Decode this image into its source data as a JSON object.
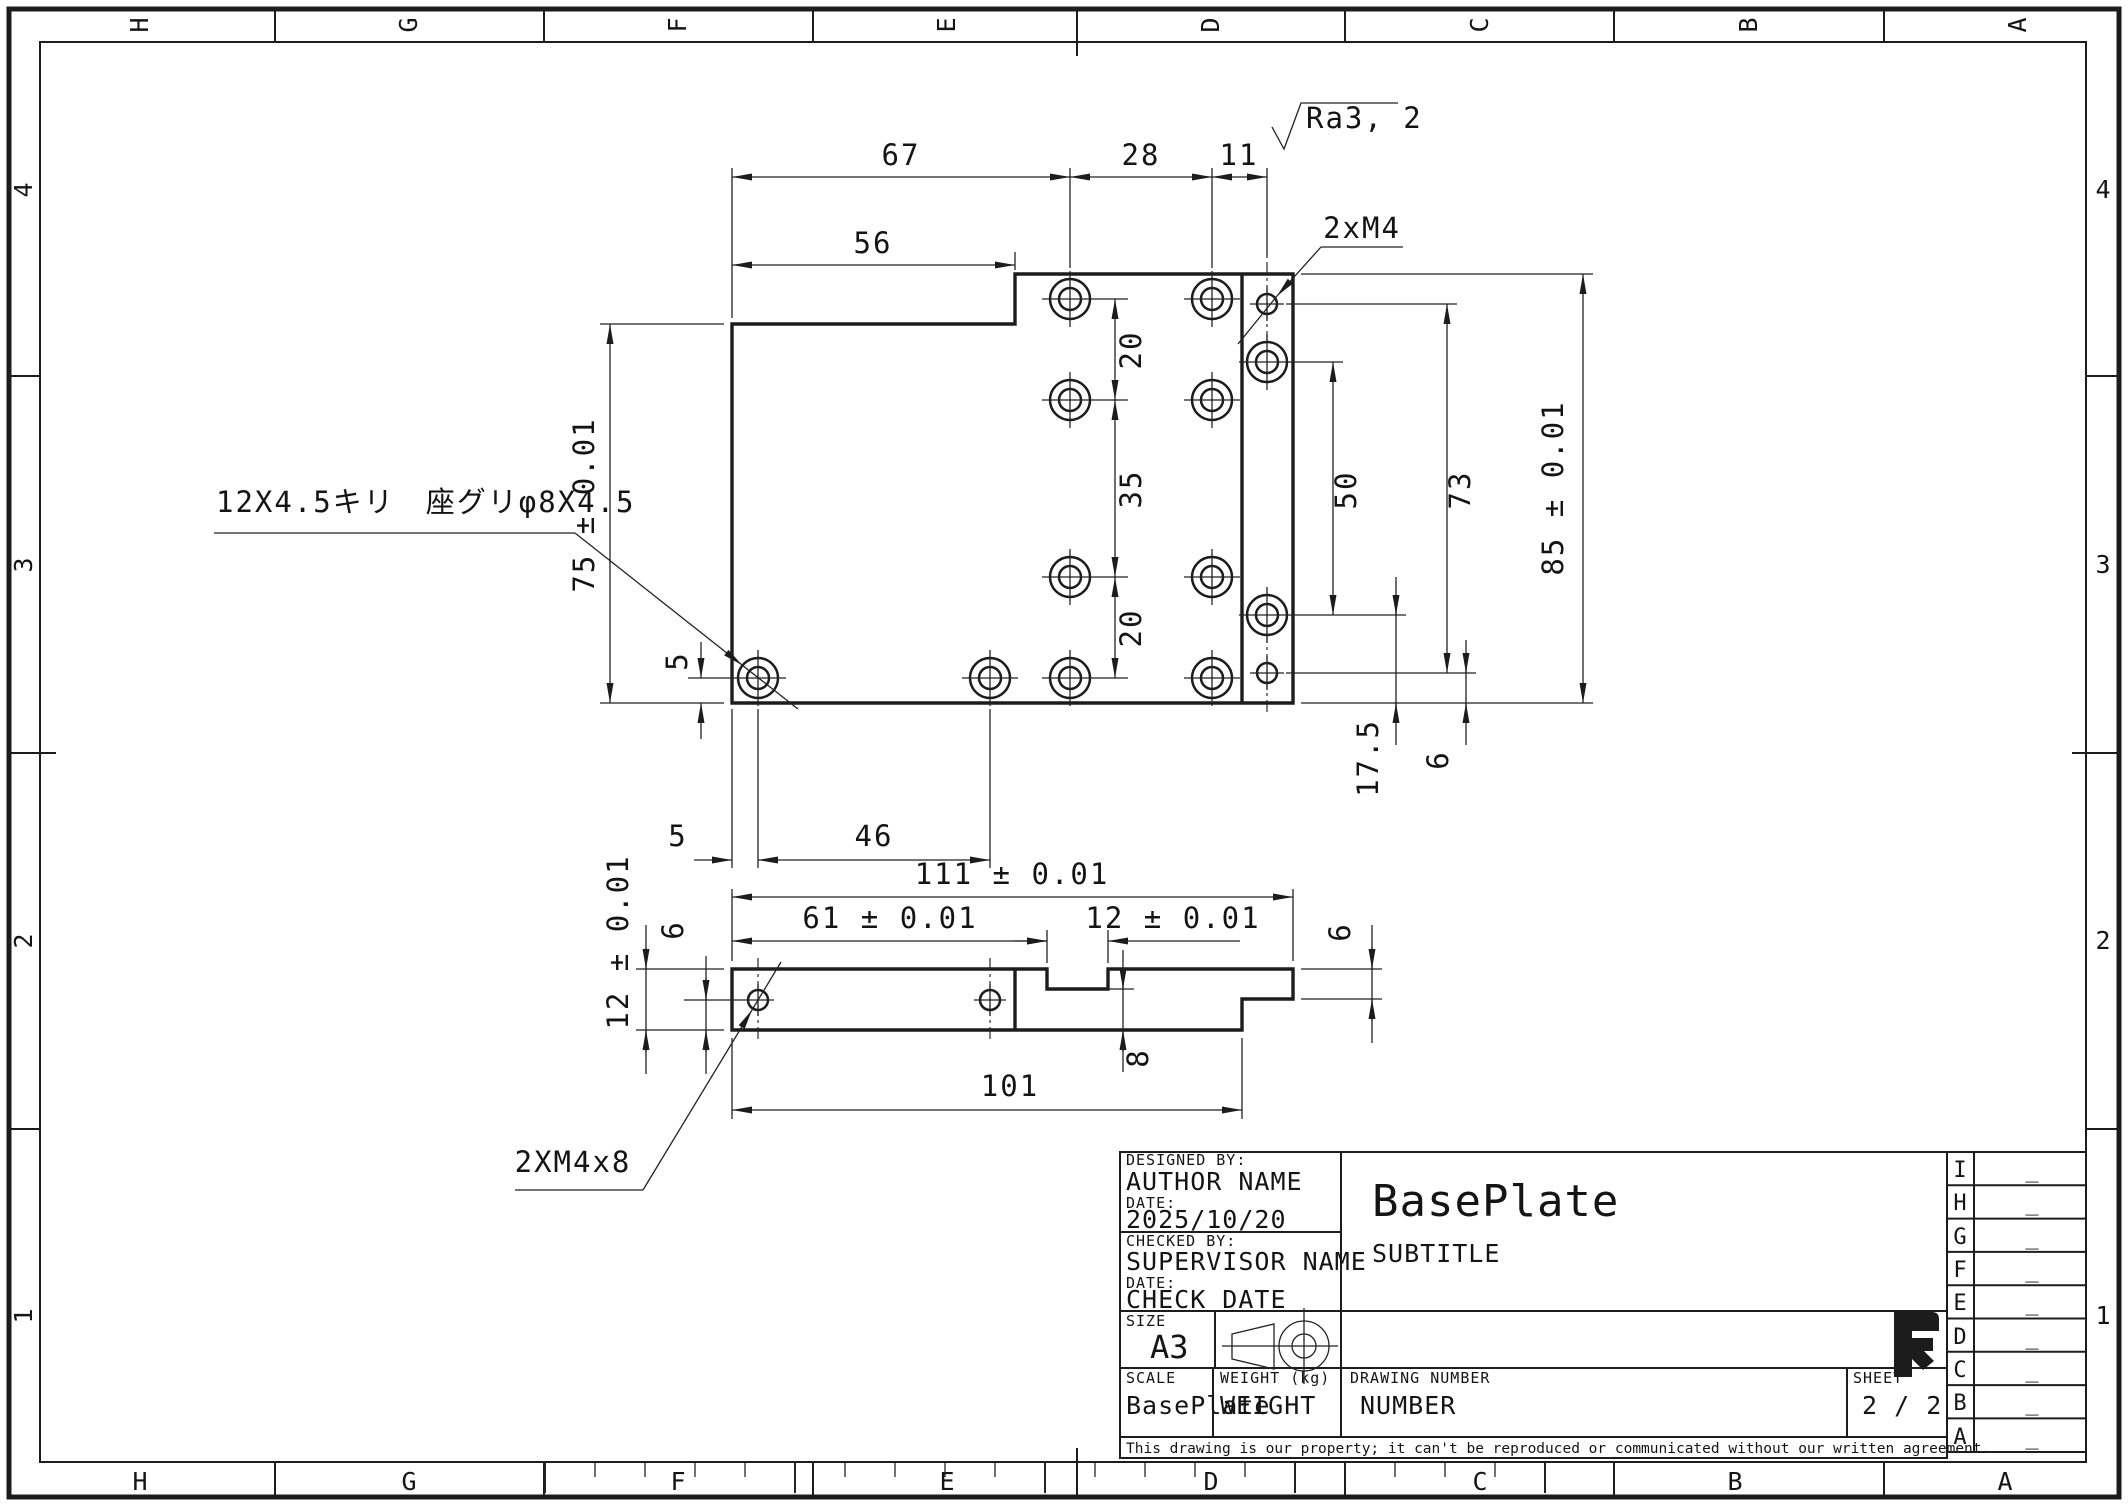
{
  "sheet": {
    "format": "A3 landscape technical drawing",
    "line_color": "#1c1c1c",
    "background": "#ffffff"
  },
  "border": {
    "top": [
      "H",
      "G",
      "F",
      "E",
      "D",
      "C",
      "B",
      "A"
    ],
    "bottom": [
      "H",
      "G",
      "F",
      "E",
      "D",
      "C",
      "B",
      "A"
    ],
    "left": [
      "4",
      "3",
      "2",
      "1"
    ],
    "right": [
      "4",
      "3",
      "2",
      "1"
    ]
  },
  "annotations": {
    "surface_finish": "Ra3, 2",
    "counterbore_note": "12X4.5キリ　座グリφ8X4.5",
    "tap_note_top": "2xM4",
    "tap_note_front": "2XM4x8"
  },
  "top_view": {
    "dims": {
      "w67": "67",
      "w28": "28",
      "w11": "11",
      "w56": "56",
      "h75": "75 ± 0.01",
      "h85": "85 ± 0.01",
      "h73": "73",
      "h50": "50",
      "p20a": "20",
      "p35": "35",
      "p20b": "20",
      "e5v": "5",
      "e5h": "5",
      "e46": "46",
      "e17_5": "17.5",
      "e6": "6"
    },
    "geometry_mm": {
      "overall_width": 111,
      "height_right": 85,
      "height_left": 75,
      "step_from_left": 56,
      "hole_columns_from_left": [
        67,
        95,
        106
      ],
      "strip_edge_from_left": 101,
      "counterbore_holes": 12,
      "tapped_holes_M4": 2
    }
  },
  "side_view": {
    "dims": {
      "w111": "111 ± 0.01",
      "w61": "61 ± 0.01",
      "w12notch": "12 ± 0.01",
      "h12": "12 ± 0.01",
      "h6_left": "6",
      "h6_right": "6",
      "w101": "101",
      "d8": "8"
    },
    "geometry_mm": {
      "thickness": 12,
      "notch_depth": 4,
      "right_tab_thickness": 6,
      "tap_depth": 8
    }
  },
  "title_block": {
    "designed_by_label": "DESIGNED BY:",
    "designed_by": "AUTHOR NAME",
    "date1_label": "DATE:",
    "date1": "2025/10/20",
    "checked_by_label": "CHECKED BY:",
    "checked_by": "SUPERVISOR NAME",
    "date2_label": "DATE:",
    "date2": "CHECK DATE",
    "size_label": "SIZE",
    "size": "A3",
    "title": "BasePlate",
    "subtitle": "SUBTITLE",
    "scale_label": "SCALE",
    "scale": "BasePlate",
    "weight_label": "WEIGHT (kg)",
    "weight": "WEIGHT",
    "drawing_number_label": "DRAWING NUMBER",
    "drawing_number": "NUMBER",
    "sheet_label": "SHEET",
    "sheet": "2 / 2",
    "disclaimer": "This drawing is our property; it can't be reproduced or communicated without our written agreement."
  },
  "revision_table": {
    "rows": [
      {
        "letter": "I",
        "value": "_"
      },
      {
        "letter": "H",
        "value": "_"
      },
      {
        "letter": "G",
        "value": "_"
      },
      {
        "letter": "F",
        "value": "_"
      },
      {
        "letter": "E",
        "value": "_"
      },
      {
        "letter": "D",
        "value": "_"
      },
      {
        "letter": "C",
        "value": "_"
      },
      {
        "letter": "B",
        "value": "_"
      },
      {
        "letter": "A",
        "value": "_"
      }
    ]
  }
}
